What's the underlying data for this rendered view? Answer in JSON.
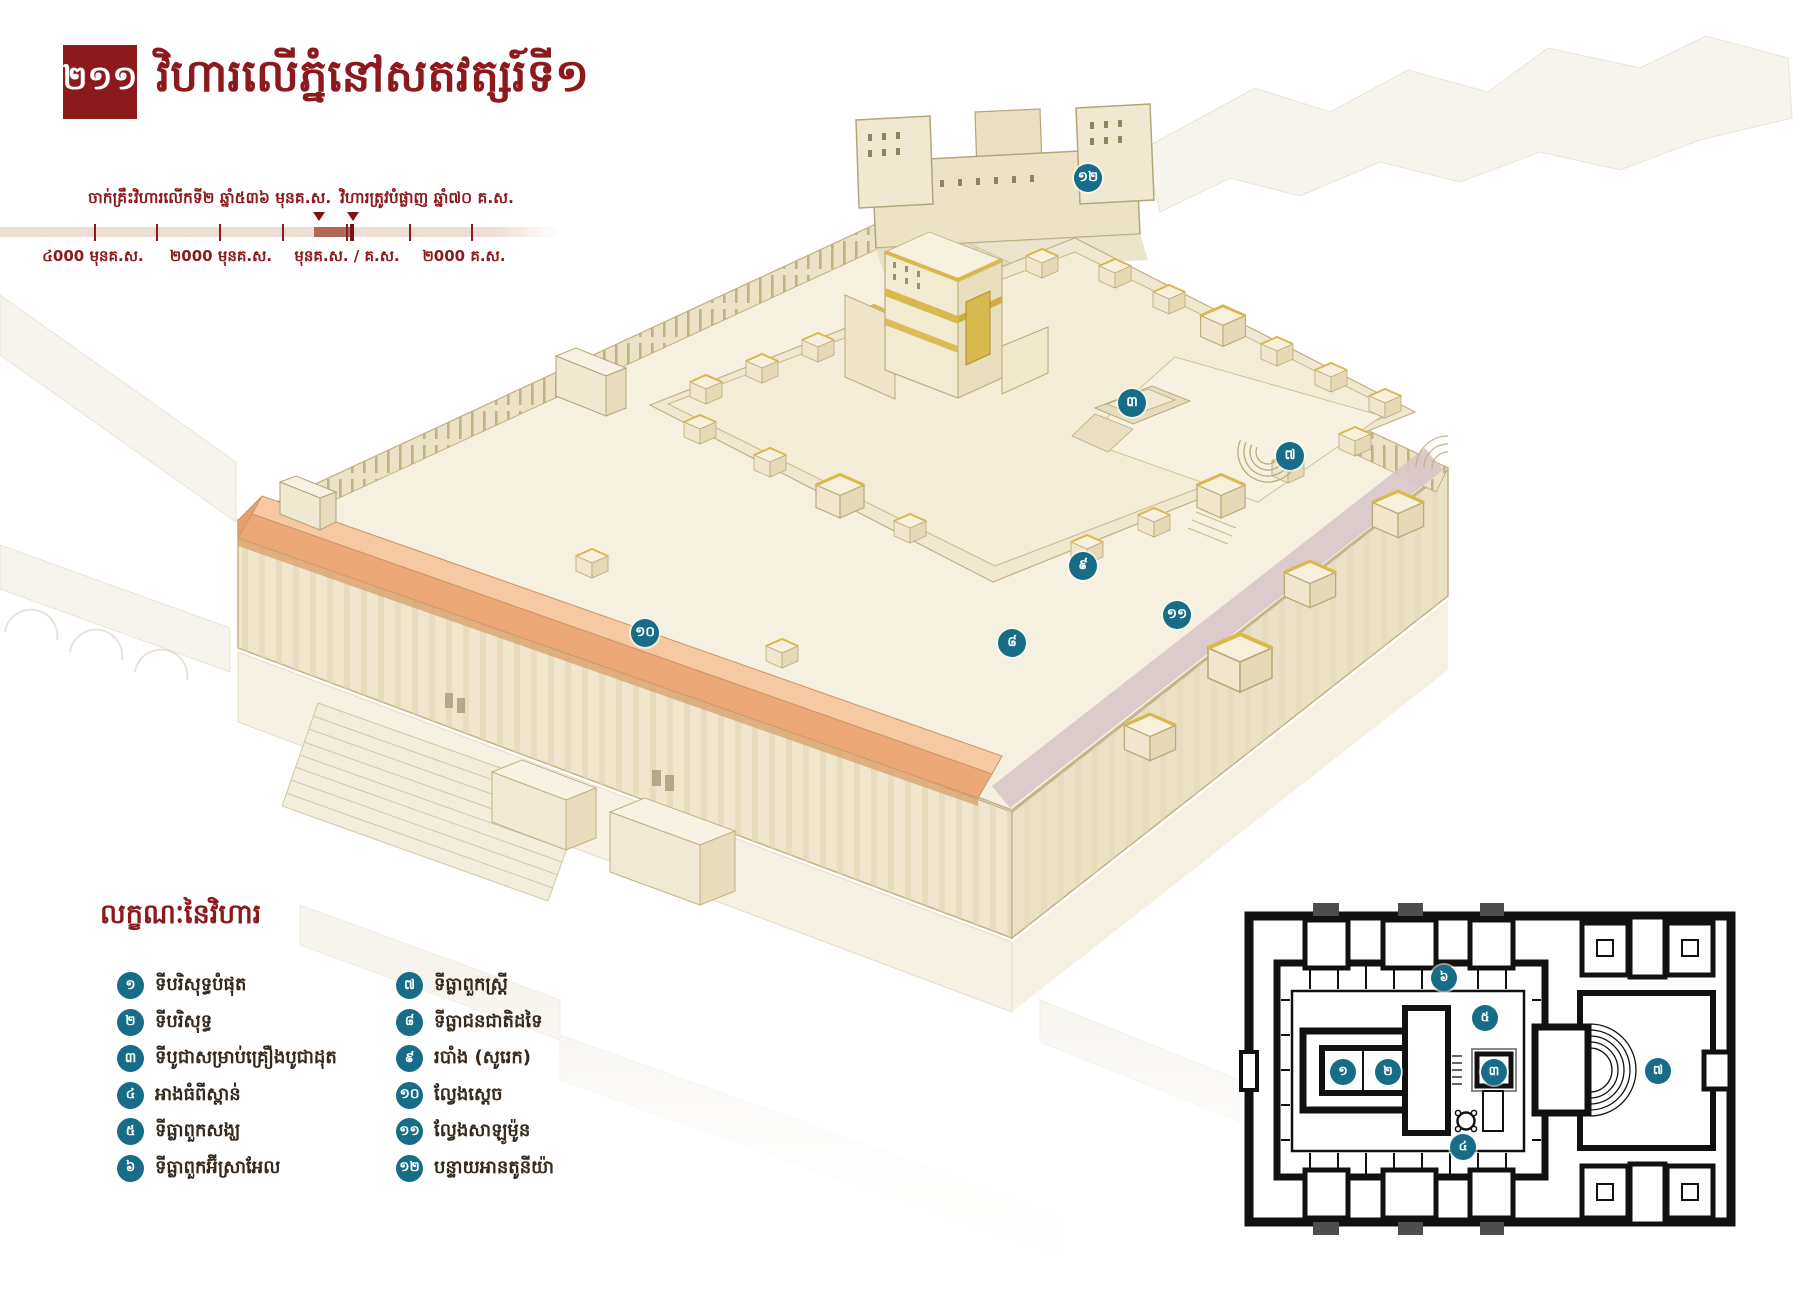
{
  "page": {
    "badge_number": "២១១",
    "title": "វិហារលើភ្នំនៅសតវត្សរ៍ទី១"
  },
  "timeline": {
    "event_labels": [
      "ចាក់គ្រឹះវិហារលើកទី២ ឆ្នាំ៥៣៦ មុនគ.ស.",
      "វិហារត្រូវបំផ្លាញ ឆ្នាំ៧០ គ.ស."
    ],
    "axis_ticks": [
      "៤000 មុនគ.ស.",
      "២000 មុនគ.ស.",
      "មុនគ.ស. / គ.ស.",
      "២000 គ.ស."
    ]
  },
  "legend": {
    "heading": "លក្ខណៈនៃវិហារ",
    "items": [
      {
        "num": "១",
        "label": "ទីបរិសុទ្ធបំផុត"
      },
      {
        "num": "២",
        "label": "ទីបរិសុទ្ធ"
      },
      {
        "num": "៣",
        "label": "ទីបូជាសម្រាប់គ្រឿងបូជាដុត"
      },
      {
        "num": "៤",
        "label": "អាងធំពីស្ពាន់"
      },
      {
        "num": "៥",
        "label": "ទីធ្លាពួកសង្ឃ"
      },
      {
        "num": "៦",
        "label": "ទីធ្លាពួកអ៊ីស្រាអែល"
      },
      {
        "num": "៧",
        "label": "ទីធ្លាពួកស្ត្រី"
      },
      {
        "num": "៨",
        "label": "ទីធ្លាជនជាតិដទៃ"
      },
      {
        "num": "៩",
        "label": "របាំង (សូរេក)"
      },
      {
        "num": "១០",
        "label": "ល្វែងស្ដេច"
      },
      {
        "num": "១១",
        "label": "ល្វែងសាឡូម៉ូន"
      },
      {
        "num": "១២",
        "label": "បន្ទាយអានតូនីយ៉ា"
      }
    ]
  },
  "markers": {
    "main": [
      "១២",
      "៣",
      "៧",
      "៩",
      "៨",
      "១០",
      "១១"
    ],
    "plan": [
      "៦",
      "៥",
      "១",
      "២",
      "៣",
      "៤",
      "៧"
    ]
  },
  "colors": {
    "accent_red": "#8c191c",
    "marker_teal": "#176d87",
    "timeline_bar": "#eeddd3",
    "timeline_highlight": "#b06a55",
    "stoa_roof": "#eda877"
  }
}
